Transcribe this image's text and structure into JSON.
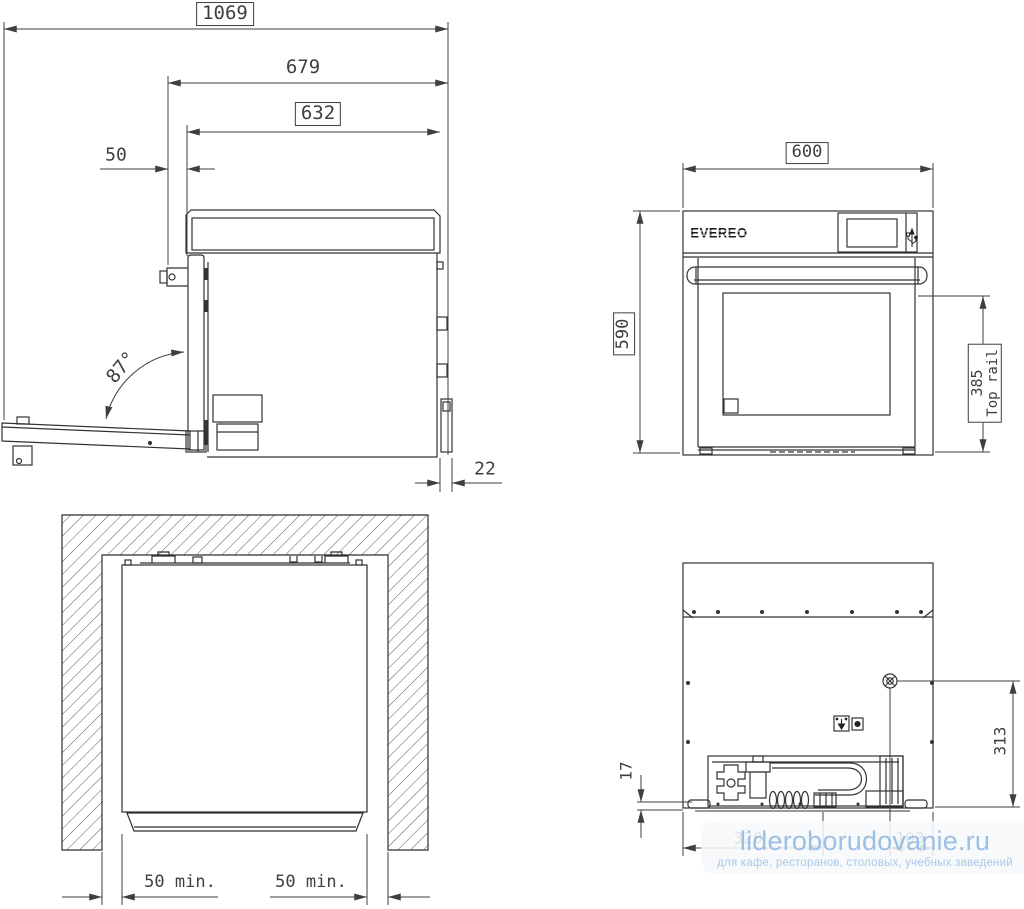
{
  "brand": {
    "logo": "EVEREO"
  },
  "labels": {
    "depth_open_total": "1069",
    "depth_with_door": "679",
    "body_depth": "632",
    "front_offset": "50",
    "door_angle": "87°",
    "rear_gap": "22",
    "width": "600",
    "height": "590",
    "top_rail_value": "385",
    "top_rail_text": "Top rail",
    "side_clearance_left": "50 min.",
    "side_clearance_right": "50 min.",
    "base_height": "17",
    "connection_height": "313",
    "obscured_dim_left": "320",
    "obscured_dim_right": "103"
  },
  "watermark": {
    "title": "lideroborudovanie.ru",
    "subtitle": "для кафе, ресторанов, столовых, учебных заведений"
  },
  "icons": {
    "usb": "usb-icon",
    "power_socket": "power-socket-icon",
    "screw_connection": "screw-connection-icon"
  },
  "colors": {
    "line": "#333333",
    "dimension": "#3f3f3f",
    "watermark_title": "#9cc0e4",
    "watermark_subtitle": "#a9c8ea",
    "panel": "rgba(246,248,250,0.87)"
  }
}
